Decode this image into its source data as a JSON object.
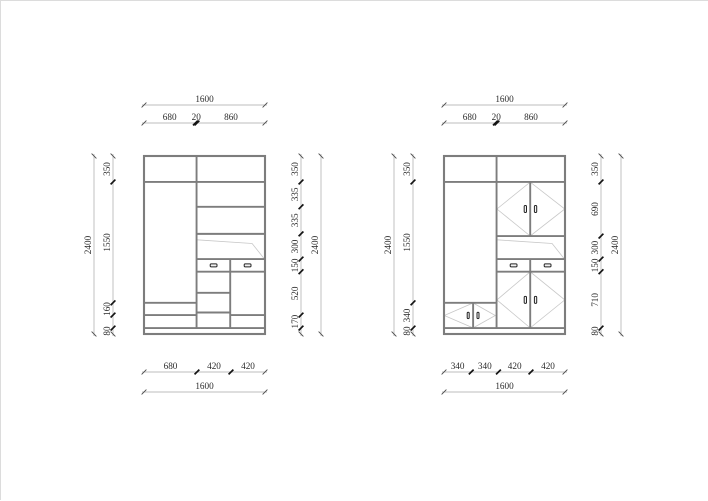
{
  "title": "wardrobe-elevation-drawings",
  "colors": {
    "background": "#ffffff",
    "structure": "#7d7d7d",
    "light": "#c8c8c8",
    "dim_line": "#a8a8a8",
    "tick_bold": "#141414",
    "tick_thin": "#4a4a4a",
    "text": "#2b2b2b",
    "handle_stroke": "#242424",
    "handle_fill": "#f2f2f2",
    "page_border": "#dcdcdc"
  },
  "canvas": {
    "width": 708,
    "height": 500
  },
  "views": [
    {
      "name": "carcass-elevation",
      "frame": {
        "x": 143,
        "y": 155,
        "w": 121,
        "h": 178
      },
      "units": {
        "w": 1600,
        "h": 2400
      },
      "structure": {
        "hlines": [
          [
            0,
            1600,
            350
          ],
          [
            0,
            695,
            1980
          ],
          [
            0,
            695,
            2145
          ],
          [
            695,
            1600,
            685
          ],
          [
            695,
            1600,
            1050
          ],
          [
            695,
            1600,
            1390
          ],
          [
            695,
            1600,
            1560
          ],
          [
            695,
            1140,
            1845
          ],
          [
            695,
            1140,
            2110
          ],
          [
            1140,
            1600,
            2145
          ],
          [
            0,
            1600,
            2320
          ]
        ],
        "vlines": [
          [
            695,
            0,
            2320
          ],
          [
            1140,
            1390,
            2320
          ]
        ],
        "lights": [
          [
            [
              700,
              1130
            ],
            [
              1430,
              1180
            ],
            [
              1590,
              1385
            ]
          ]
        ],
        "handles": [
          [
            920,
            1475,
            90,
            40
          ],
          [
            1370,
            1475,
            90,
            40
          ]
        ]
      },
      "dims": [
        {
          "name": "top-overall",
          "orient": "h",
          "pos": 104,
          "ticks": [
            0,
            1600
          ],
          "labels": [
            "1600"
          ]
        },
        {
          "name": "top-sections",
          "orient": "h",
          "pos": 122,
          "ticks": [
            0,
            680,
            700,
            1600
          ],
          "labels": [
            "680",
            "20",
            "860"
          ]
        },
        {
          "name": "bottom-sections",
          "orient": "h",
          "pos": 371,
          "ticks": [
            0,
            700,
            1150,
            1600
          ],
          "labels": [
            "680",
            "420",
            "420"
          ]
        },
        {
          "name": "bottom-overall",
          "orient": "h",
          "pos": 391,
          "ticks": [
            0,
            1600
          ],
          "labels": [
            "1600"
          ]
        },
        {
          "name": "left-overall",
          "orient": "v",
          "pos": 93,
          "ticks": [
            0,
            2400
          ],
          "labels": [
            "2400"
          ]
        },
        {
          "name": "left-sections",
          "orient": "v",
          "pos": 112,
          "ticks": [
            0,
            350,
            1980,
            2145,
            2320,
            2400
          ],
          "labels": [
            "350",
            "1550",
            "160",
            "",
            "80"
          ]
        },
        {
          "name": "right-sections",
          "orient": "v",
          "pos": 300,
          "ticks": [
            0,
            350,
            685,
            1050,
            1390,
            1560,
            2145,
            2320,
            2400
          ],
          "labels": [
            "350",
            "335",
            "335",
            "300",
            "150",
            "520",
            "170",
            ""
          ]
        },
        {
          "name": "right-overall",
          "orient": "v",
          "pos": 320,
          "ticks": [
            0,
            2400
          ],
          "labels": [
            "2400"
          ]
        }
      ]
    },
    {
      "name": "door-elevation",
      "frame": {
        "x": 443,
        "y": 155,
        "w": 121,
        "h": 178
      },
      "units": {
        "w": 1600,
        "h": 2400
      },
      "structure": {
        "hlines": [
          [
            0,
            1600,
            350
          ],
          [
            0,
            695,
            1980
          ],
          [
            695,
            1600,
            1080
          ],
          [
            695,
            1600,
            1390
          ],
          [
            695,
            1600,
            1560
          ],
          [
            0,
            1600,
            2320
          ]
        ],
        "vlines": [
          [
            695,
            0,
            2320
          ],
          [
            1140,
            350,
            1080
          ],
          [
            1140,
            1390,
            1560
          ],
          [
            1140,
            1560,
            2320
          ],
          [
            385,
            1980,
            2320
          ]
        ],
        "lights": [
          [
            [
              700,
              1130
            ],
            [
              1430,
              1180
            ],
            [
              1590,
              1385
            ]
          ],
          [
            [
              700,
              715
            ],
            [
              1140,
              352
            ],
            [
              1598,
              715
            ],
            [
              1140,
              1078
            ],
            [
              700,
              715
            ]
          ],
          [
            [
              700,
              1940
            ],
            [
              1140,
              1562
            ],
            [
              1598,
              1940
            ],
            [
              1140,
              2318
            ],
            [
              700,
              1940
            ]
          ],
          [
            [
              4,
              2150
            ],
            [
              385,
              1982
            ],
            [
              678,
              2150
            ],
            [
              385,
              2318
            ],
            [
              4,
              2150
            ]
          ]
        ],
        "handles": [
          [
            920,
            1475,
            90,
            40
          ],
          [
            1370,
            1475,
            90,
            40
          ],
          [
            1075,
            715,
            30,
            95
          ],
          [
            1210,
            715,
            30,
            95
          ],
          [
            1075,
            1940,
            30,
            95
          ],
          [
            1210,
            1940,
            30,
            95
          ],
          [
            320,
            2150,
            26,
            85
          ],
          [
            450,
            2150,
            26,
            85
          ]
        ]
      },
      "dims": [
        {
          "name": "top-overall",
          "orient": "h",
          "pos": 104,
          "ticks": [
            0,
            1600
          ],
          "labels": [
            "1600"
          ]
        },
        {
          "name": "top-sections",
          "orient": "h",
          "pos": 122,
          "ticks": [
            0,
            680,
            700,
            1600
          ],
          "labels": [
            "680",
            "20",
            "860"
          ]
        },
        {
          "name": "bottom-sections",
          "orient": "h",
          "pos": 371,
          "ticks": [
            0,
            360,
            720,
            1150,
            1600
          ],
          "labels": [
            "340",
            "340",
            "420",
            "420"
          ]
        },
        {
          "name": "bottom-overall",
          "orient": "h",
          "pos": 391,
          "ticks": [
            0,
            1600
          ],
          "labels": [
            "1600"
          ]
        },
        {
          "name": "left-overall",
          "orient": "v",
          "pos": 393,
          "ticks": [
            0,
            2400
          ],
          "labels": [
            "2400"
          ]
        },
        {
          "name": "left-sections",
          "orient": "v",
          "pos": 412,
          "ticks": [
            0,
            350,
            1980,
            2320,
            2400
          ],
          "labels": [
            "350",
            "1550",
            "340",
            "80"
          ]
        },
        {
          "name": "right-sections",
          "orient": "v",
          "pos": 600,
          "ticks": [
            0,
            350,
            1080,
            1390,
            1560,
            2320,
            2400
          ],
          "labels": [
            "350",
            "690",
            "300",
            "150",
            "710",
            "80"
          ]
        },
        {
          "name": "right-overall",
          "orient": "v",
          "pos": 620,
          "ticks": [
            0,
            2400
          ],
          "labels": [
            "2400"
          ]
        }
      ]
    }
  ]
}
